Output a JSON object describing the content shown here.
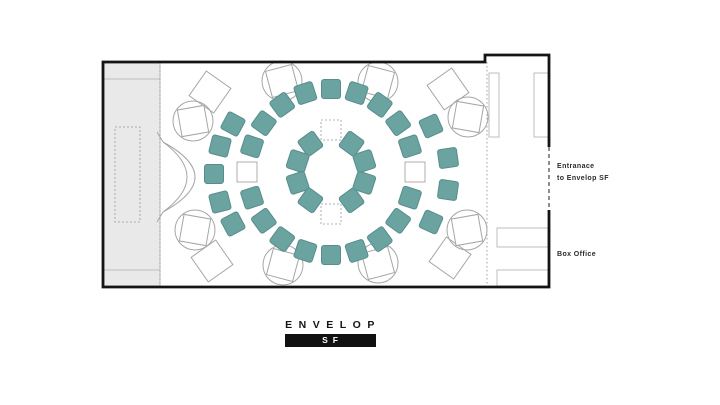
{
  "title": "Envelop SF seating floor plan",
  "labels": {
    "entrance_line1": "Entranace",
    "entrance_line2": "to Envelop SF",
    "box_office": "Box Office"
  },
  "logo": {
    "name": "ENVELOP",
    "badge": "SF"
  },
  "colors": {
    "seat": "#6ba3a1",
    "seat_border": "#568e8c",
    "wall": "#141414",
    "outline": "#a6a6a6",
    "light_outline": "#bdbdbd",
    "stage_fill": "#e9e9e9",
    "dash": "#999999",
    "entrance_dash": "#555555",
    "text": "#2b2b2b",
    "logo_bg": "#111111"
  },
  "plan": {
    "width": 720,
    "height": 405,
    "walls_path": "M549,210 V287 H103 V62 H485 V55 H549 V147",
    "entrance_gap": {
      "x": 549,
      "y1": 147,
      "y2": 210
    },
    "dotted_dividers": [
      {
        "x": 160,
        "y1": 62,
        "y2": 286
      },
      {
        "x": 487,
        "y1": 62,
        "y2": 286
      }
    ],
    "stage": {
      "x": 104,
      "y": 63,
      "w": 56,
      "h": 223,
      "divider_y1": 79,
      "divider_y2": 270,
      "dashed_rect": {
        "x": 115,
        "y": 127,
        "w": 25,
        "h": 95
      }
    },
    "crescent_paths": [
      "M163,142 Q227,177 163,212",
      "M163,142 Q211,177 163,212",
      "M163,142 L157,132",
      "M163,212 L157,222"
    ],
    "vestibule_rects": [
      {
        "x": 489,
        "y": 73,
        "w": 10,
        "h": 64
      },
      {
        "x": 534,
        "y": 73,
        "w": 15,
        "h": 64
      },
      {
        "x": 497,
        "y": 228,
        "w": 51,
        "h": 19
      },
      {
        "x": 497,
        "y": 270,
        "w": 51,
        "h": 16
      }
    ],
    "seating": {
      "center": {
        "x": 331,
        "y": 172
      },
      "seat_size": 19,
      "rings": [
        {
          "name": "inner",
          "radius": 35,
          "angles": [
            18,
            54,
            126,
            162,
            198,
            234,
            306,
            342
          ],
          "placeholders": {
            "radius": 42,
            "angles": [
              90,
              270
            ],
            "style": "dashed",
            "size": 20
          }
        },
        {
          "name": "middle",
          "radius": 83,
          "angles": [
            18,
            36,
            54,
            72,
            90,
            108,
            126,
            144,
            162,
            198,
            216,
            234,
            252,
            270,
            288,
            306,
            324,
            342
          ],
          "placeholders": {
            "radius": 84,
            "angles": [
              0,
              180
            ],
            "style": "solid",
            "size": 20
          }
        }
      ],
      "outer_seats": [
        {
          "x": 233,
          "y": 124,
          "rot": 28
        },
        {
          "x": 220,
          "y": 146,
          "rot": 14
        },
        {
          "x": 214,
          "y": 174,
          "rot": 0
        },
        {
          "x": 220,
          "y": 202,
          "rot": -14
        },
        {
          "x": 233,
          "y": 224,
          "rot": -28
        },
        {
          "x": 431,
          "y": 126,
          "rot": -24
        },
        {
          "x": 448,
          "y": 158,
          "rot": -8
        },
        {
          "x": 448,
          "y": 190,
          "rot": 8
        },
        {
          "x": 431,
          "y": 222,
          "rot": 24
        }
      ]
    },
    "speakers": [
      {
        "x": 282,
        "y": 81,
        "rot": -15
      },
      {
        "x": 378,
        "y": 82,
        "rot": 15
      },
      {
        "x": 193,
        "y": 121,
        "rot": -10
      },
      {
        "x": 468,
        "y": 117,
        "rot": 10
      },
      {
        "x": 195,
        "y": 230,
        "rot": 10
      },
      {
        "x": 467,
        "y": 230,
        "rot": -10
      },
      {
        "x": 283,
        "y": 265,
        "rot": 15
      },
      {
        "x": 378,
        "y": 263,
        "rot": -15
      }
    ],
    "speaker_circle_r": 20,
    "speaker_square": 27,
    "corner_squares": [
      {
        "x": 210,
        "y": 92,
        "rot": 35
      },
      {
        "x": 448,
        "y": 89,
        "rot": -35
      },
      {
        "x": 212,
        "y": 261,
        "rot": -35
      },
      {
        "x": 450,
        "y": 258,
        "rot": 35
      }
    ],
    "corner_square_size": 30
  }
}
